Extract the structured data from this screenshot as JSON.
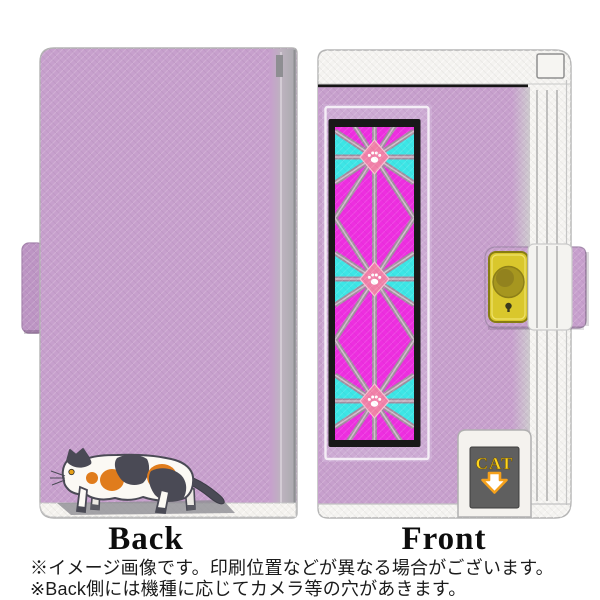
{
  "page": {
    "back": {
      "label": "Back"
    },
    "front": {
      "label": "Front",
      "badge": {
        "text": "CAT"
      }
    },
    "notes": {
      "line1": "※イメージ画像です。印刷位置などが異なる場合がございます。",
      "line2": "※Back側には機種に応じてカメラ等の穴があきます。"
    },
    "colors": {
      "case_lilac": "#c7a0cd",
      "case_lilac_frame": "#cdabd4",
      "spine_grey_edge": "#a9a9ad",
      "pattern_magenta": "#ee2ee0",
      "pattern_cyan": "#3ce6e6",
      "lattice_mauve": "#a28da0",
      "diamond_pink": "#f180a8",
      "button_yellow": "#d9c72c",
      "button_snap_olive": "#a6961f",
      "badge_bg_grey": "#5f5f5f",
      "badge_text_yellow": "#ffd61e",
      "arrow_orange": "#f5a11c",
      "cat_dark_patch": "#4a4a55",
      "cat_orange_patch": "#e07c1c",
      "cat_body_white": "#fbf9f4"
    }
  }
}
